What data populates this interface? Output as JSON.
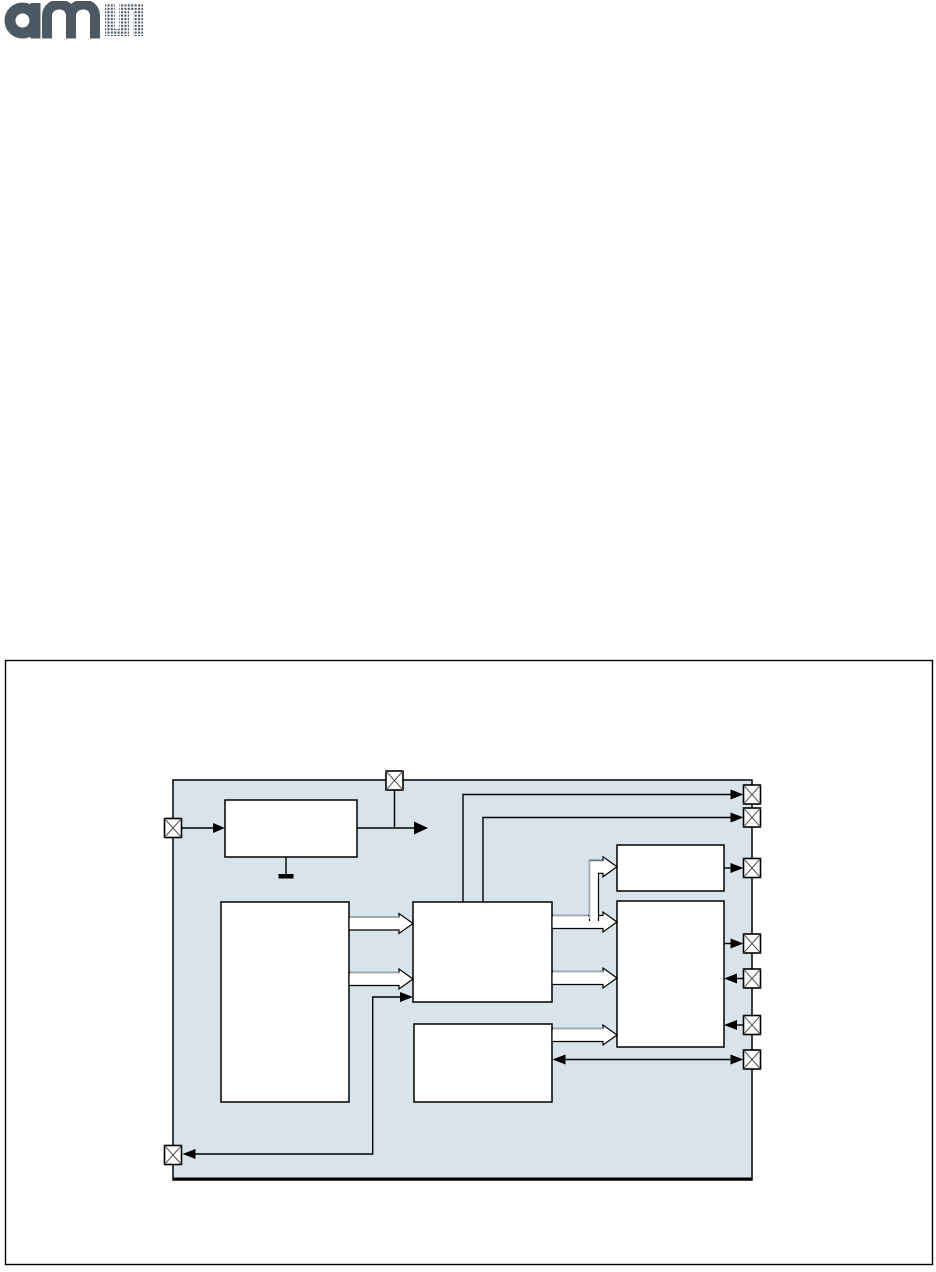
{
  "logo": {
    "wordmark": "am",
    "halftone_letter": "s",
    "color": "#4c5862"
  },
  "colors": {
    "line": "#000000",
    "chip_fill": "#d9e4ea",
    "block_fill": "#ffffff",
    "hollow_arrow_highlight": "#98a6ae",
    "pin_cross": "#555555",
    "frame_border": "#000000"
  },
  "figure": {
    "description": "block diagram inside empty figure frame",
    "blocks": [
      {
        "id": "top-left-block",
        "label": ""
      },
      {
        "id": "left-large-block",
        "label": ""
      },
      {
        "id": "center-block",
        "label": ""
      },
      {
        "id": "center-lower-block",
        "label": ""
      },
      {
        "id": "right-small-block",
        "label": ""
      },
      {
        "id": "right-large-block",
        "label": ""
      }
    ],
    "pins": [
      {
        "id": "pin-top",
        "side": "top",
        "symbol": "crossed-square"
      },
      {
        "id": "pin-left",
        "side": "left",
        "symbol": "crossed-square"
      },
      {
        "id": "pin-bottom-left",
        "side": "left",
        "symbol": "crossed-square"
      },
      {
        "id": "pin-right-1",
        "side": "right",
        "symbol": "crossed-square"
      },
      {
        "id": "pin-right-2",
        "side": "right",
        "symbol": "crossed-square"
      },
      {
        "id": "pin-right-3",
        "side": "right",
        "symbol": "crossed-square"
      },
      {
        "id": "pin-right-4",
        "side": "right",
        "symbol": "crossed-square"
      },
      {
        "id": "pin-right-5",
        "side": "right",
        "symbol": "crossed-square"
      },
      {
        "id": "pin-right-6",
        "side": "right",
        "symbol": "crossed-square"
      },
      {
        "id": "pin-right-7",
        "side": "right",
        "symbol": "crossed-square"
      }
    ],
    "connections": [
      {
        "from": "pin-left",
        "to": "top-left-block",
        "style": "thin-arrow"
      },
      {
        "from": "top-left-block",
        "to": "pin-top-junction",
        "style": "thin-arrow"
      },
      {
        "from": "top-left-block",
        "to": "ground",
        "style": "ground-symbol"
      },
      {
        "from": "center-block",
        "to": "pin-right-1",
        "style": "thin-arrow"
      },
      {
        "from": "center-block",
        "to": "pin-right-2",
        "style": "thin-arrow"
      },
      {
        "from": "left-large-block",
        "to": "center-block",
        "style": "hollow-arrow",
        "count": 2
      },
      {
        "from": "center-block",
        "to": "right-large-block",
        "style": "hollow-arrow",
        "count": 2
      },
      {
        "from": "center-block",
        "to": "right-small-block",
        "style": "hollow-arrow-branch"
      },
      {
        "from": "center-lower-block",
        "to": "right-large-block",
        "style": "hollow-arrow"
      },
      {
        "from": "right-small-block",
        "to": "pin-right-3",
        "style": "thin-arrow"
      },
      {
        "from": "right-large-block",
        "to": "pin-right-4",
        "style": "thin-arrow"
      },
      {
        "from": "pin-right-5",
        "to": "right-large-block",
        "style": "thin-arrow"
      },
      {
        "from": "pin-right-6",
        "to": "right-large-block",
        "style": "thin-arrow"
      },
      {
        "from": "center-lower-block",
        "to": "pin-right-7",
        "style": "double-arrow"
      },
      {
        "from": "pin-bottom-left",
        "to": "center-block",
        "style": "double-arrow-elbow"
      }
    ]
  }
}
